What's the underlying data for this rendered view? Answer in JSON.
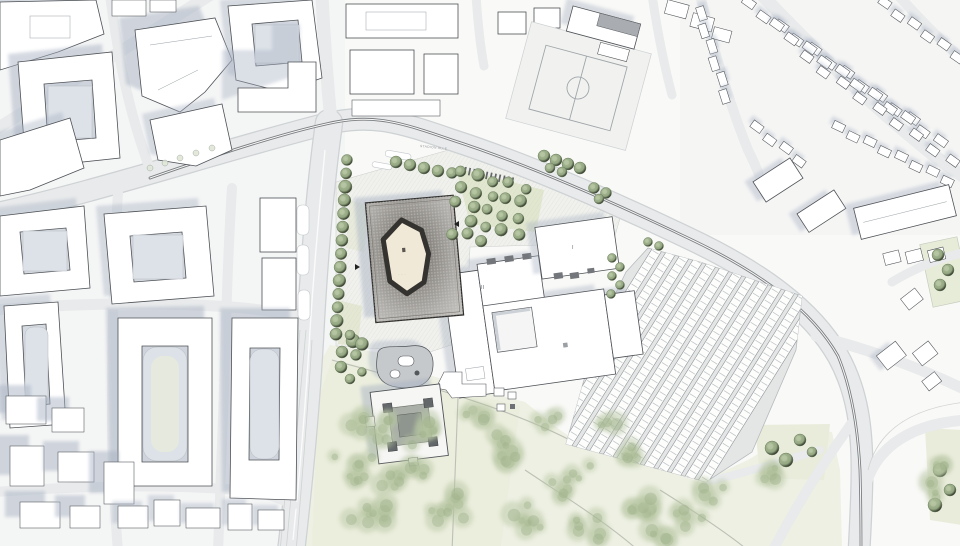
{
  "figure": {
    "title": "architectural masterplan site drawing",
    "north_up": true
  },
  "labels": {
    "street_name": "STADION ALLE",
    "building_numeral_1": "I",
    "building_numeral_2": "II",
    "mosque_courtyard_note": "·· ··· ··",
    "plaza_note": "·· ··"
  },
  "palette": {
    "paper": "#f9f9f7",
    "road": "#e8eaeb",
    "rail": "#7b7f83",
    "building": "#ffffff",
    "outline": "#4d5156",
    "shadow": "#a7b1c2",
    "plaza": "#f0f1ed",
    "park": "#edf0e2",
    "lawn": "#e9ecdb",
    "treedark": "#8ba07b",
    "treepark": "#b5c4a0",
    "roofdark": "#57534e",
    "courtyard": "#f1e9d7",
    "courtring": "#35332f"
  }
}
